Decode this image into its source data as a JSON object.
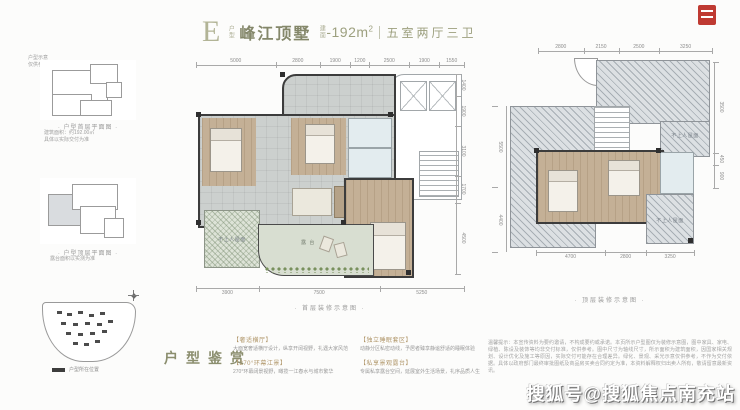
{
  "header": {
    "type_letter": "E",
    "type_suffix": "户型",
    "name": "峰江顶墅",
    "area_prefix": "建面",
    "area_value": "-192m",
    "area_sup": "2",
    "layout": "五室两厅三卫"
  },
  "sidebar": {
    "note_top_1": "户型示意",
    "note_top_2": "仅供参考",
    "thumb1_caption": "· 户型首层平面图 ·",
    "thumb1_note1": "建筑面积：约192.00㎡",
    "thumb1_note2": "具体以实际交付为准",
    "thumb2_caption": "· 户型顶层平面图 ·",
    "thumb2_note": "露台面积以实测为准",
    "siteplan_legend": "户型所在位置"
  },
  "main_plan": {
    "dims_top": [
      "5000",
      "2800",
      "1900",
      "1200",
      "2500",
      "1900",
      "1550"
    ],
    "dims_right": [
      "1400",
      "1900",
      "3100",
      "1700",
      "4500"
    ],
    "dims_bottom": [
      "3900",
      "7500",
      "5250"
    ],
    "caption": "· 首层装修示意图 ·",
    "labels": {
      "roof": "不上人屋面",
      "terrace": "露 台"
    }
  },
  "top_plan": {
    "dims_top": [
      "2800",
      "2150",
      "2500",
      "3250"
    ],
    "dims_left": [
      "5500",
      "4400"
    ],
    "dims_right": [
      "3500",
      "450",
      "900"
    ],
    "dims_bottom": [
      "4700",
      "2800",
      "3250"
    ],
    "caption": "· 顶层装修示意图 ·",
    "labels": {
      "roof": "不上人屋面"
    }
  },
  "appreciation": {
    "title": "户型鉴赏",
    "items": [
      {
        "head": "【奢适横厅】",
        "body": "大面宽奢适横厅设计，纵享开阔视野，礼遇大家风范"
      },
      {
        "head": "【270°环幕江景】",
        "body": "270°环幕阔景视野，瞰揽一江春水与城市繁华"
      },
      {
        "head": "【独立睡眠套区】",
        "body": "动静分区私密动线，予居者臻享静谧舒适的睡眠体验"
      },
      {
        "head": "【私享景观露台】",
        "body": "专属私享露台空间，延展室外生活场景，礼序品质人生"
      }
    ]
  },
  "disclaimer": "温馨提示：本宣传资料为要约邀请，不构成要约或承诺。本页所示户型图仅为装修示意图，图中家具、家电、绿植、陈设及装饰等均非交付标准，仅供参考。图中尺寸为轴线尺寸，所示面积为建筑面积，因国家相关规划、设计优化及施工等原因，实际交付可能存在合理差异。绿化、景观、采光示意仅供参考，不作为交付依据。具体以政府部门最终审批图纸及商品房买卖合同约定为准，本资料解释权归出卖人所有，敬请留意最新资讯。",
  "watermark": "搜狐号@搜狐焦点南充站"
}
